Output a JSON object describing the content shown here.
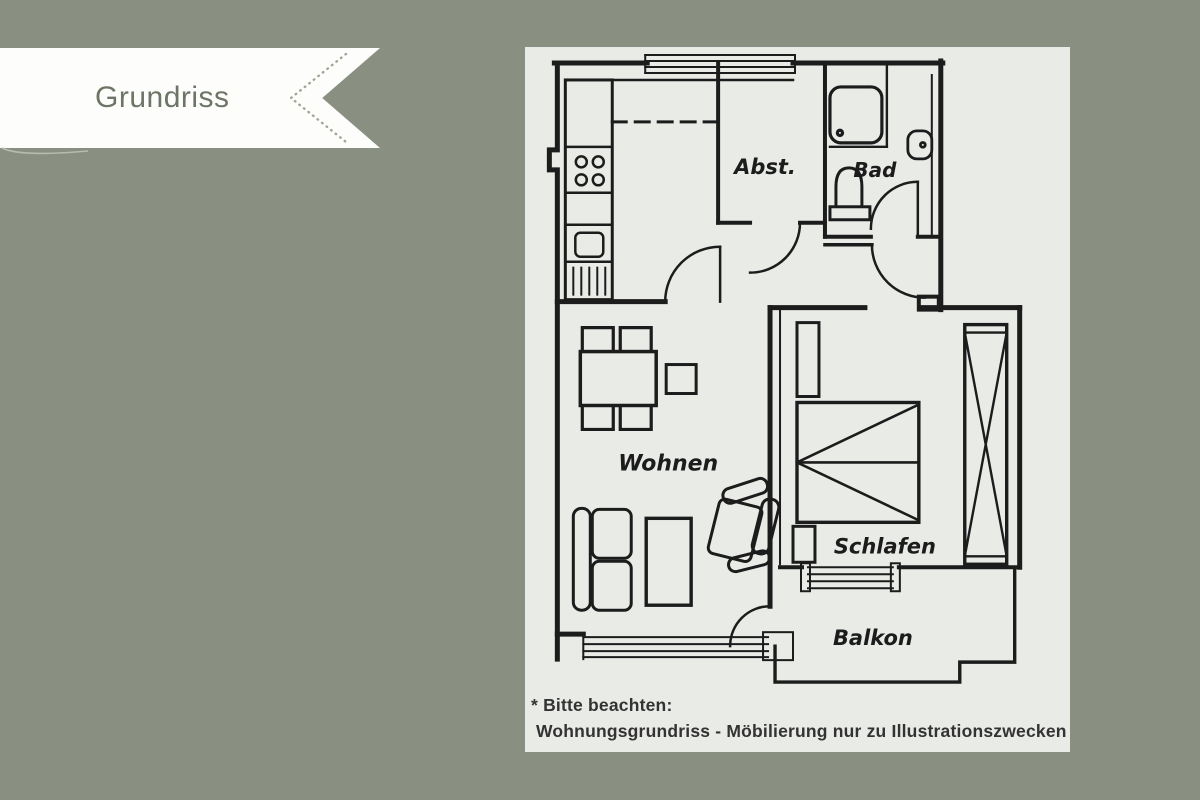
{
  "banner": {
    "title": "Grundriss"
  },
  "plan": {
    "rooms": [
      {
        "id": "abst",
        "label": "Abst."
      },
      {
        "id": "bad",
        "label": "Bad"
      },
      {
        "id": "wohnen",
        "label": "Wohnen"
      },
      {
        "id": "schlafen",
        "label": "Schlafen"
      },
      {
        "id": "balkon",
        "label": "Balkon"
      }
    ]
  },
  "note": {
    "line1": "* Bitte beachten:",
    "line2": "Wohnungsgrundriss - Möbilierung nur zu Illustrationszwecken"
  },
  "colors": {
    "background": "#8a9081",
    "panel": "#e9ebe7",
    "plan_line": "#1c1c1c",
    "banner_fill": "#fdfdfb",
    "banner_text": "#6d7566",
    "note_text": "#333333"
  }
}
